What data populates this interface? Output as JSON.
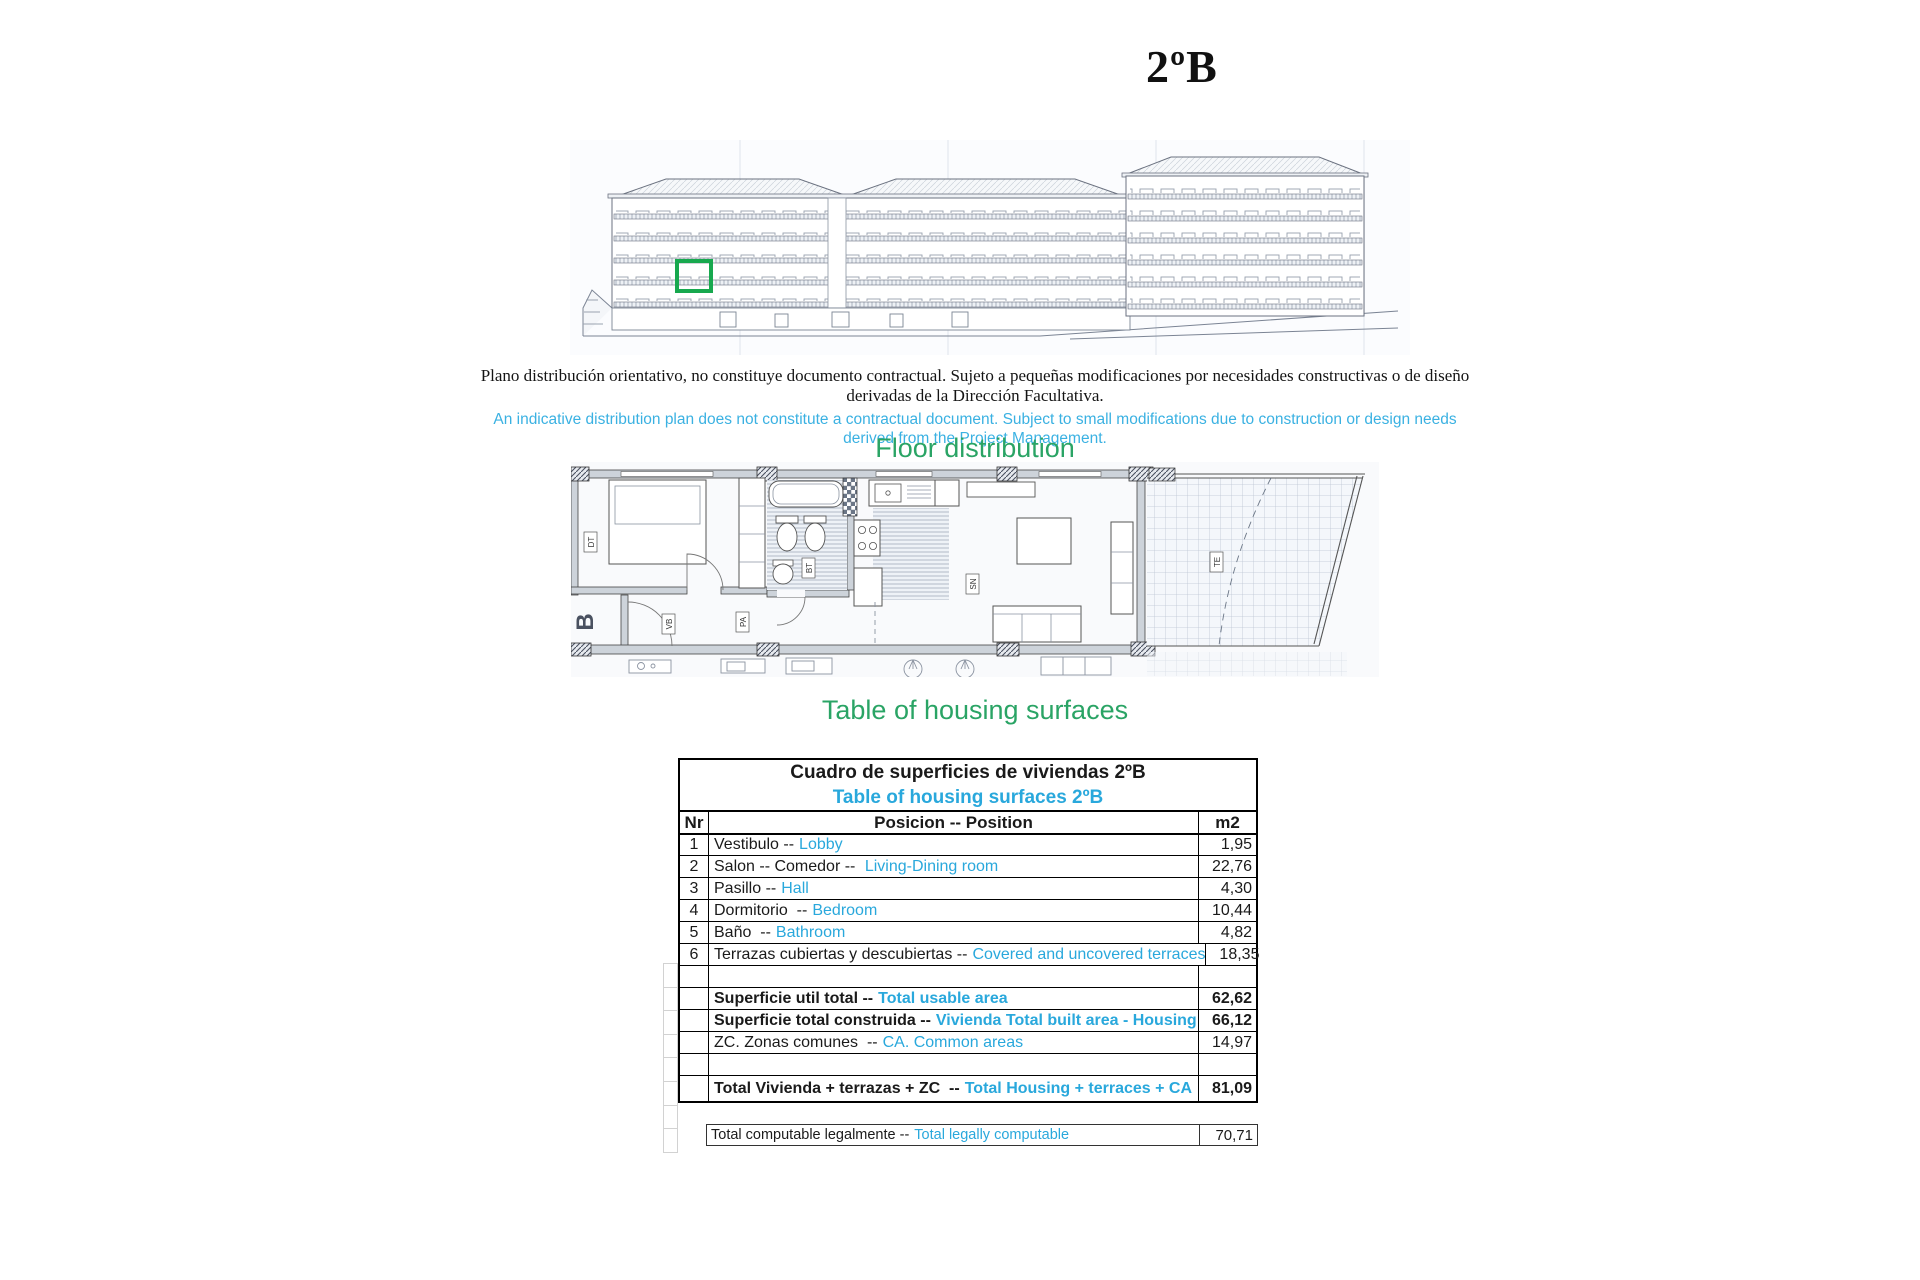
{
  "page": {
    "title": "2ºB"
  },
  "disclaimer": {
    "es_line1": "Plano distribución orientativo, no constituye documento contractual. Sujeto a pequeñas modificaciones por necesidades constructivas o de diseño",
    "es_line2": "derivadas de la Dirección Facultativa.",
    "en_line1": "An indicative distribution plan does not constitute a contractual document. Subject to small modifications due to construction or design needs",
    "en_line2": "derived from the Project Management."
  },
  "headings": {
    "floor_distribution": "Floor distribution",
    "housing_surfaces": "Table of housing surfaces"
  },
  "colors": {
    "accent_green": "#2aa465",
    "accent_cyan": "#29a8dc",
    "unit_marker_green": "#17a84e"
  },
  "plan_labels": {
    "block_letter": "B",
    "bedroom_tag": "DT",
    "hall_tag": "VB",
    "corridor_tag": "PA",
    "bath_tag": "BT",
    "living_tag": "SN",
    "terrace_tag": "TE"
  },
  "table": {
    "title_es": "Cuadro de superficies de viviendas 2ºB",
    "title_en": "Table of housing surfaces 2ºB",
    "headers": {
      "nr": "Nr",
      "position": "Posicion -- Position",
      "unit": "m2"
    },
    "rows": [
      {
        "nr": "1",
        "es": "Vestibulo --",
        "en": "Lobby",
        "m2": "1,95"
      },
      {
        "nr": "2",
        "es": "Salon -- Comedor -- ",
        "en": "Living-Dining room",
        "m2": "22,76"
      },
      {
        "nr": "3",
        "es": "Pasillo --",
        "en": "Hall",
        "m2": "4,30"
      },
      {
        "nr": "4",
        "es": "Dormitorio  --",
        "en": "Bedroom",
        "m2": "10,44"
      },
      {
        "nr": "5",
        "es": "Baño  --",
        "en": "Bathroom",
        "m2": "4,82"
      },
      {
        "nr": "6",
        "es": "Terrazas cubiertas y descubiertas --",
        "en": "Covered and uncovered terraces",
        "m2": "18,35"
      }
    ],
    "summary": [
      {
        "es": "Superficie util total --",
        "en": "Total usable area",
        "m2": "62,62"
      },
      {
        "es": "Superficie total construida --",
        "en": "Vivienda Total built area - Housing",
        "m2": "66,12"
      },
      {
        "es": "ZC. Zonas comunes  --",
        "en": "CA. Common areas",
        "m2": "14,97"
      }
    ],
    "total": {
      "es": "Total Vivienda + terrazas + ZC  --",
      "en": "Total Housing + terraces + CA",
      "m2": "81,09"
    },
    "legal": {
      "es": "Total computable legalmente --",
      "en": "Total legally computable",
      "m2": "70,71"
    }
  }
}
